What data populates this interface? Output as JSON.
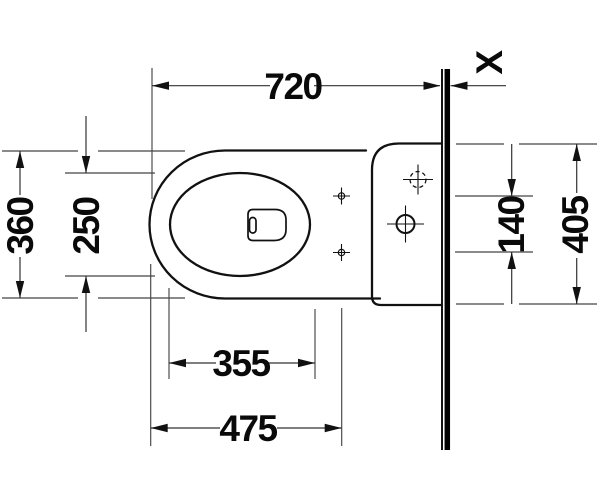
{
  "drawing": {
    "background_color": "#ffffff",
    "line_color": "#111111",
    "dimensions": {
      "total_depth": "720",
      "outer_width": "360",
      "bowl_inner_width": "250",
      "bowl_inner_length": "355",
      "front_to_fixing_holes": "475",
      "fixing_hole_spacing": "140",
      "cistern_width": "405",
      "wall_thickness": "X"
    }
  }
}
